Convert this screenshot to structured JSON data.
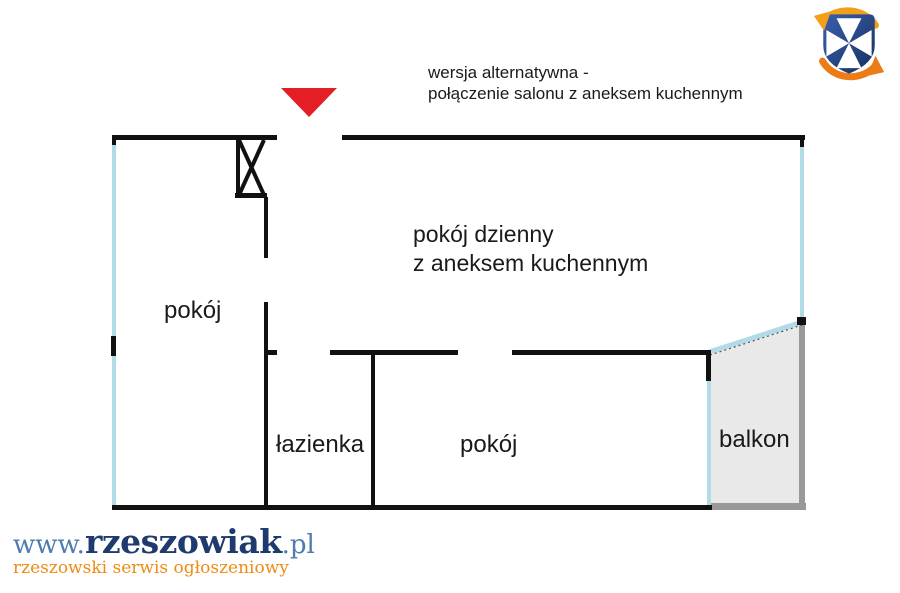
{
  "annotation": {
    "line1": "wersja alternatywna -",
    "line2": "połączenie salonu z aneksem kuchennym"
  },
  "rooms": {
    "living_line1": "pokój dzienny",
    "living_line2": "z aneksem kuchennym",
    "left_room": "pokój",
    "bathroom": "łazienka",
    "bottom_room": "pokój",
    "balcony": "balkon"
  },
  "icons": {
    "entrance": "entrance-arrow-icon (red triangle pointing down at main door)",
    "shaft": "vent-shaft-icon (box with X hatch)",
    "crest": "rzeszow-city-crest-icon (blue shield, white cross, orange circular arrows)"
  },
  "footer": {
    "www": "www.",
    "name": "rzeszowiak",
    "tld": ".pl",
    "tagline": "rzeszowski serwis ogłoszeniowy"
  },
  "colors": {
    "wall": "#111111",
    "window": "#b2dbe7",
    "window_dash": "#555555",
    "balcony_fill": "#e9e9e9",
    "balcony_border": "#999999",
    "entrance_arrow": "#e31e24",
    "label_text": "#1a1a1a",
    "logo_www_blue": "#4d7cb0",
    "logo_name_navy": "#1f3a6e",
    "logo_tagline_orange": "#ee8c12",
    "crest_blue": "#3a5fae",
    "crest_blue_dark": "#16305e",
    "crest_orange_top": "#f2a019",
    "crest_orange_bottom": "#ec7c15"
  }
}
